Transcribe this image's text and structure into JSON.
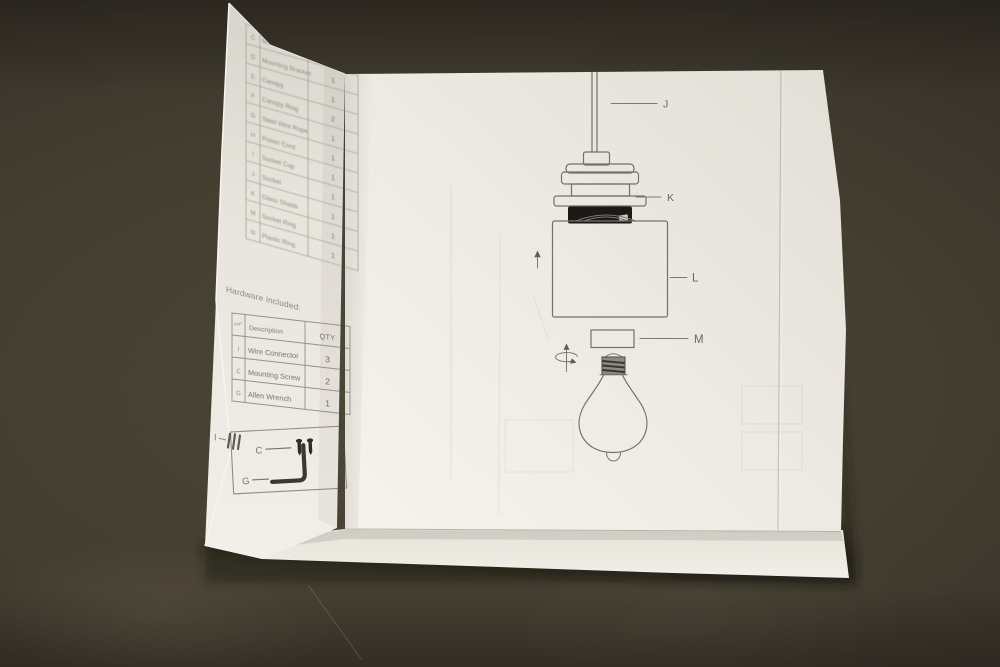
{
  "parts_table": {
    "rows": [
      {
        "letter": "C",
        "description": "Mounting Screw",
        "qty": ""
      },
      {
        "letter": "D",
        "description": "Mounting Bracket",
        "qty": "1"
      },
      {
        "letter": "E",
        "description": "Canopy",
        "qty": "1"
      },
      {
        "letter": "F",
        "description": "Canopy Ring",
        "qty": "2"
      },
      {
        "letter": "G",
        "description": "Steel Wire Rope",
        "qty": "1"
      },
      {
        "letter": "H",
        "description": "Power Cord",
        "qty": "1"
      },
      {
        "letter": "I",
        "description": "Socket Cup",
        "qty": "1"
      },
      {
        "letter": "J",
        "description": "Socket",
        "qty": "1"
      },
      {
        "letter": "K",
        "description": "Glass Shade",
        "qty": "1"
      },
      {
        "letter": "M",
        "description": "Socket Ring",
        "qty": "1"
      },
      {
        "letter": "N",
        "description": "Plastic Ring",
        "qty": "1"
      }
    ]
  },
  "hardware": {
    "title": "Hardware included:",
    "header": {
      "part": "Part",
      "description": "Description",
      "qty": "QTY"
    },
    "rows": [
      {
        "letter": "I",
        "description": "Wire Connector",
        "qty": "3"
      },
      {
        "letter": "C",
        "description": "Mounting Screw",
        "qty": "2"
      },
      {
        "letter": "G",
        "description": "Allen Wrench",
        "qty": "1"
      }
    ]
  },
  "hardware_key": {
    "items": [
      {
        "letter": "I",
        "icon": "wire-connector-icon"
      },
      {
        "letter": "C",
        "icon": "mounting-screws-icon"
      },
      {
        "letter": "G",
        "icon": "allen-wrench-icon"
      }
    ]
  },
  "diagram": {
    "labels": [
      {
        "id": "J",
        "part": "power-cord"
      },
      {
        "id": "K",
        "part": "socket-ring"
      },
      {
        "id": "L",
        "part": "glass-shade"
      },
      {
        "id": "M",
        "part": "shade-ring"
      }
    ]
  },
  "colors": {
    "background": "#3f3a2f",
    "paper": "#efece5",
    "print_ink": "#73716b",
    "socket_ring_black": "#1b1815"
  }
}
